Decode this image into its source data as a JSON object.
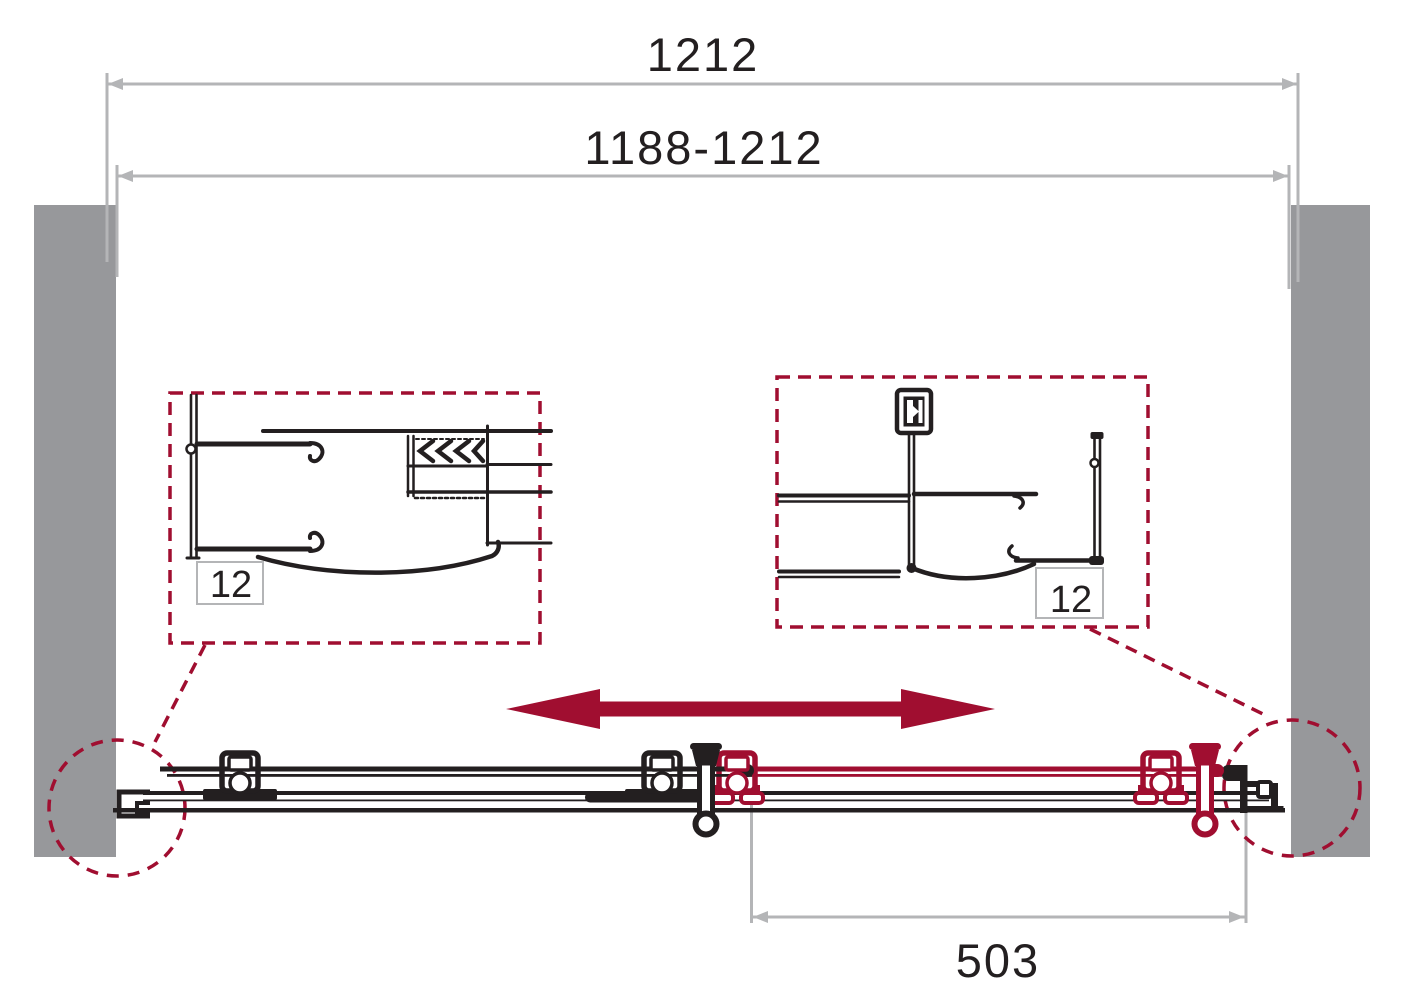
{
  "diagram": {
    "type": "sliding-shower-door-technical-drawing",
    "dimensions": {
      "overall_width": "1212",
      "adjustment_range": "1188-1212",
      "door_width": "503"
    },
    "details": {
      "left_profile": "12",
      "right_profile": "12"
    },
    "colors": {
      "accent": "#a00e30",
      "wall": "#97989b",
      "dim": "#b4b5b7",
      "ink": "#231f20"
    }
  }
}
